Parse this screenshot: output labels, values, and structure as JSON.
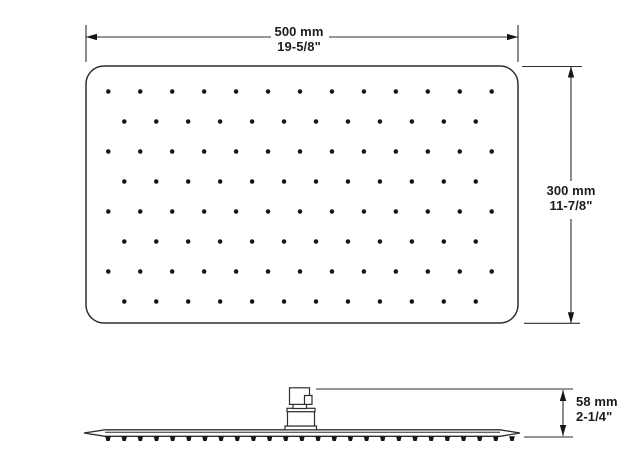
{
  "colors": {
    "line": "#2e2e2e",
    "ink": "#161616",
    "background": "#ffffff",
    "text": "#1c1c1c"
  },
  "dimensions": {
    "width": {
      "metric": "500 mm",
      "imperial": "19-5/8\""
    },
    "height": {
      "metric": "300 mm",
      "imperial": "11-7/8\""
    },
    "depth": {
      "metric": "58 mm",
      "imperial": "2-1/4\""
    }
  },
  "drawing": {
    "canvas": {
      "w": 629,
      "h": 468
    },
    "arrow": {
      "len": 11,
      "half_w": 3.2
    },
    "top_view": {
      "plate": {
        "x": 86,
        "y": 66,
        "w": 432,
        "h": 257,
        "rx": 18,
        "stroke_w": 1.5
      },
      "dots": {
        "rows": 8,
        "y0": 91.5,
        "dy": 30.0,
        "r": 2.25,
        "dx": 31.95,
        "odd_row": {
          "count": 13,
          "x0": 108.3
        },
        "even_row": {
          "count": 12,
          "x0": 124.3
        }
      }
    },
    "dim_width": {
      "ext_lines": [
        [
          86,
          25,
          86,
          62
        ],
        [
          518,
          25,
          518,
          62
        ]
      ],
      "segments": [
        [
          86,
          37,
          271,
          37
        ],
        [
          329,
          37,
          518,
          37
        ]
      ],
      "arrows": [
        [
          86,
          37,
          "l"
        ],
        [
          518,
          37,
          "r"
        ]
      ]
    },
    "dim_height": {
      "ext_lines": [
        [
          522,
          66.5,
          582,
          66.5
        ],
        [
          524,
          323.3,
          580,
          323.3
        ]
      ],
      "segments": [
        [
          571,
          66.5,
          571,
          181
        ],
        [
          571,
          219,
          571,
          323.3
        ]
      ],
      "arrows": [
        [
          571,
          66.5,
          "u"
        ],
        [
          571,
          323.3,
          "d"
        ]
      ]
    },
    "side_view": {
      "outline": [
        [
          84,
          433
        ],
        [
          105,
          429.8
        ],
        [
          500,
          429.8
        ],
        [
          520,
          433
        ],
        [
          500,
          436.3
        ],
        [
          105,
          436.3
        ]
      ],
      "inner_line": [
        105,
        432.2,
        500,
        432.2
      ],
      "nozzles": {
        "count": 26,
        "x_start": 108,
        "x_end": 512,
        "y_top": 436.3,
        "y_bottom": 441,
        "top_half_w": 2.8,
        "bottom_half_w": 1.6
      },
      "connector_rects": [
        [
          285.0,
          426.0,
          31.5,
          3.8
        ],
        [
          287.5,
          411.5,
          27.0,
          14.5
        ],
        [
          287.0,
          408.3,
          28.0,
          3.4
        ],
        [
          293.0,
          404.3,
          13.5,
          4.2
        ],
        [
          289.5,
          387.8,
          20.0,
          16.6
        ],
        [
          304.5,
          395.5,
          7.5,
          8.9
        ]
      ]
    },
    "dim_depth": {
      "ext_lines": [
        [
          316,
          389,
          573,
          389
        ],
        [
          524,
          437,
          573,
          437
        ]
      ],
      "segments": [
        [
          563,
          390,
          563,
          436
        ]
      ],
      "arrows": [
        [
          563,
          390,
          "u"
        ],
        [
          563,
          436,
          "d"
        ]
      ]
    }
  }
}
